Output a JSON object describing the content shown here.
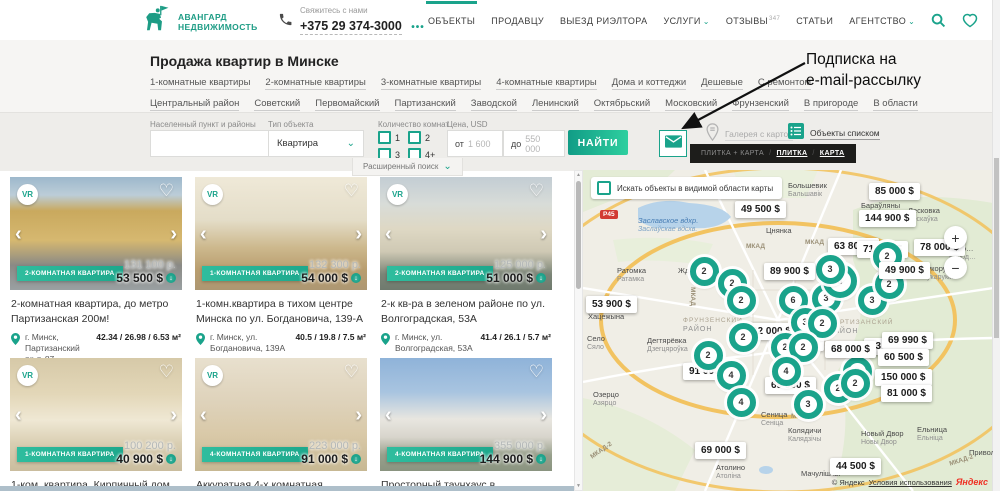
{
  "colors": {
    "accent": "#1aa38b",
    "accent_light": "#2ecf9f",
    "yandex_red": "#ef3124",
    "tooltip_bg": "#1d1d1b"
  },
  "glyphs": {
    "vr": "VR",
    "heart": "♡",
    "chevron_left": "‹",
    "chevron_right": "›",
    "price_drop": "↓",
    "separator": "/",
    "select_chevron": "⌄",
    "nav_chevron": "⌄",
    "scroll_up": "▲",
    "scroll_down": "▼"
  },
  "header": {
    "logo": {
      "line1": "АВАНГАРД",
      "line2": "НЕДВИЖИМОСТЬ"
    },
    "phone": {
      "label": "Свяжитесь с нами",
      "number": "+375 29 374-3000",
      "more": "•••"
    },
    "nav": [
      {
        "label": "ОБЪЕКТЫ",
        "active": true
      },
      {
        "label": "ПРОДАВЦУ"
      },
      {
        "label": "ВЫЕЗД РИЭЛТОРА"
      },
      {
        "label": "УСЛУГИ",
        "chevron": true
      },
      {
        "label": "ОТЗЫВЫ",
        "badge": "347"
      },
      {
        "label": "СТАТЬИ"
      },
      {
        "label": "АГЕНТСТВО",
        "chevron": true
      }
    ]
  },
  "annotation": {
    "line1": "Подписка на",
    "line2": "e-mail-рассылку"
  },
  "intro": {
    "title": "Продажа квартир в Минске",
    "links_row1": [
      "1-комнатные квартиры",
      "2-комнатные квартиры",
      "3-комнатные квартиры",
      "4-комнатные квартиры",
      "Дома и коттеджи",
      "Дешевые",
      "С ремонтом"
    ],
    "links_row2": [
      "Центральный район",
      "Советский",
      "Первомайский",
      "Партизанский",
      "Заводской",
      "Ленинский",
      "Октябрьский",
      "Московский",
      "Фрунзенский",
      "В пригороде",
      "В области"
    ]
  },
  "filters": {
    "location_label": "Населенный пункт и районы",
    "type_label": "Тип объекта",
    "type_value": "Квартира",
    "rooms_label": "Количество комнат",
    "rooms": [
      "1",
      "2",
      "3",
      "4+"
    ],
    "price_label": "Цена, USD",
    "price_from_prefix": "от",
    "price_from": "1 600",
    "price_to_prefix": "до",
    "price_to": "550 000",
    "search_button": "НАЙТИ",
    "advanced": "Расширенный поиск",
    "gallery_label": "Галерея с картой",
    "list_label": "Объекты списком",
    "view_tooltip": [
      {
        "label": "ПЛИТКА + КАРТА",
        "active": false
      },
      {
        "label": "ПЛИТКА",
        "active": true
      },
      {
        "label": "КАРТА",
        "active": true
      }
    ]
  },
  "cards": [
    {
      "vr": true,
      "badge": "2-КОМНАТНАЯ КВАРТИРА",
      "byn": "131 100 р.",
      "usd": "53 500 $",
      "title": "2-комнатная квартира, до метро Партизанская 200м!",
      "loc": "г. Минск, Партизанский пр-т. 87",
      "area": "42.34 / 26.98 / 6.53 м²",
      "photo": "yellow-building"
    },
    {
      "vr": true,
      "badge": "1-КОМНАТНАЯ КВАРТИРА",
      "byn": "132 300 р.",
      "usd": "54 000 $",
      "title": "1-комн.квартира в тихом центре Минска по ул. Богдановича, 139-А",
      "loc": "г. Минск, ул. Богдановича, 139А",
      "area": "40.5 / 19.8 / 7.5 м²",
      "photo": "living-room"
    },
    {
      "vr": true,
      "badge": "2-КОМНАТНАЯ КВАРТИРА",
      "byn": "125 000 р.",
      "usd": "51 000 $",
      "title": "2-к кв-ра в зеленом районе по ул. Волгоградская, 53А",
      "loc": "г. Минск, ул. Волгоградская, 53А",
      "area": "41.4 / 26.1 / 5.7 м²",
      "photo": "beige-room"
    },
    {
      "vr": true,
      "badge": "1-КОМНАТНАЯ КВАРТИРА",
      "byn": "100 200 р.",
      "usd": "40 900 $",
      "title": "1-ком. квартира. Кирпичный дом. 150 метров",
      "photo": "warm-room"
    },
    {
      "vr": true,
      "badge": "4-КОМНАТНАЯ КВАРТИРА",
      "byn": "223 000 р.",
      "usd": "91 000 $",
      "title": "Аккуратная 4-х комнатная квартира с",
      "photo": "bedroom"
    },
    {
      "vr": false,
      "badge": "4-КОМНАТНАЯ КВАРТИРА",
      "byn": "355 000 р.",
      "usd": "144 900 $",
      "title": "Просторный таунхаус в экологически чистом",
      "photo": "townhouse"
    }
  ],
  "map": {
    "search_area_label": "Искать объекты в видимой области карты",
    "zoom_in": "+",
    "zoom_out": "−",
    "road_badge": "Р45",
    "copyright": {
      "prefix": "© Яндекс",
      "link": "Условия использования",
      "brand": "Яндекс"
    },
    "price_labels": [
      {
        "t": "49 500 $",
        "x": 152,
        "y": 31
      },
      {
        "t": "85 000 $",
        "x": 286,
        "y": 13
      },
      {
        "t": "144 900 $",
        "x": 276,
        "y": 40
      },
      {
        "t": "78 000 $",
        "x": 331,
        "y": 69
      },
      {
        "t": "63 800 $",
        "x": 245,
        "y": 68,
        "p": true
      },
      {
        "t": "71 000 $",
        "x": 274,
        "y": 71,
        "p": true
      },
      {
        "t": "49 900 $",
        "x": 296,
        "y": 92
      },
      {
        "t": "89 900 $",
        "x": 181,
        "y": 93
      },
      {
        "t": "53 900 $",
        "x": 3,
        "y": 126
      },
      {
        "t": "32 000 $",
        "x": 163,
        "y": 153,
        "p": true
      },
      {
        "t": "22 000 $",
        "x": 190,
        "y": 164,
        "p": true
      },
      {
        "t": "68 000 $",
        "x": 242,
        "y": 171
      },
      {
        "t": "43",
        "x": 281,
        "y": 168,
        "p": true
      },
      {
        "t": "69 990 $",
        "x": 299,
        "y": 162
      },
      {
        "t": "60 500 $",
        "x": 295,
        "y": 179
      },
      {
        "t": "150 000 $",
        "x": 292,
        "y": 199
      },
      {
        "t": "91 000 $",
        "x": 100,
        "y": 193,
        "p": true
      },
      {
        "t": "69 900 $",
        "x": 182,
        "y": 207,
        "p": true
      },
      {
        "t": "81 000 $",
        "x": 298,
        "y": 215
      },
      {
        "t": "69 000 $",
        "x": 112,
        "y": 272
      },
      {
        "t": "44 500 $",
        "x": 247,
        "y": 288
      }
    ],
    "clusters": [
      {
        "n": "2",
        "x": 121,
        "y": 101
      },
      {
        "n": "2",
        "x": 149,
        "y": 113
      },
      {
        "n": "2",
        "x": 158,
        "y": 130
      },
      {
        "n": "6",
        "x": 210,
        "y": 130
      },
      {
        "n": "3",
        "x": 243,
        "y": 128
      },
      {
        "n": "3",
        "x": 257,
        "y": 111,
        "s": 34
      },
      {
        "n": "3",
        "x": 247,
        "y": 99
      },
      {
        "n": "3",
        "x": 289,
        "y": 130
      },
      {
        "n": "2",
        "x": 306,
        "y": 114
      },
      {
        "n": "2",
        "x": 304,
        "y": 86
      },
      {
        "n": "3",
        "x": 222,
        "y": 152
      },
      {
        "n": "2",
        "x": 239,
        "y": 153
      },
      {
        "n": "2",
        "x": 160,
        "y": 167
      },
      {
        "n": "2",
        "x": 202,
        "y": 177
      },
      {
        "n": "2",
        "x": 220,
        "y": 177
      },
      {
        "n": "2",
        "x": 125,
        "y": 185
      },
      {
        "n": "4",
        "x": 203,
        "y": 201
      },
      {
        "n": "3",
        "x": 274,
        "y": 201
      },
      {
        "n": "4",
        "x": 148,
        "y": 205
      },
      {
        "n": "4",
        "x": 158,
        "y": 232
      },
      {
        "n": "3",
        "x": 225,
        "y": 234
      },
      {
        "n": "2",
        "x": 255,
        "y": 218
      },
      {
        "n": "2",
        "x": 272,
        "y": 213
      }
    ],
    "places": [
      {
        "l1": "Заславское вдхр.",
        "l2": "Заслаўскае вдсхв.",
        "x": 55,
        "y": 46,
        "kind": "water"
      },
      {
        "l1": "Цнянка",
        "x": 183,
        "y": 56,
        "kind": "town"
      },
      {
        "l1": "Большевик",
        "l2": "Бальшавік",
        "x": 205,
        "y": 11,
        "kind": "town"
      },
      {
        "l1": "Бараўляны",
        "x": 278,
        "y": 31,
        "kind": "town"
      },
      {
        "l1": "Лесковка",
        "l2": "Лескаўка",
        "x": 325,
        "y": 36,
        "kind": "town"
      },
      {
        "l1": "Коло…",
        "l2": "Калод…",
        "x": 366,
        "y": 74,
        "kind": "town"
      },
      {
        "l1": "Сукорукие",
        "l2": "Сукарукія",
        "x": 339,
        "y": 94,
        "kind": "town"
      },
      {
        "l1": "Ратомка",
        "l2": "Ратамка",
        "x": 34,
        "y": 96,
        "kind": "town"
      },
      {
        "l1": "Жда…",
        "x": 95,
        "y": 96,
        "kind": "town"
      },
      {
        "l1": "Хацежына",
        "x": 5,
        "y": 142,
        "kind": "town"
      },
      {
        "l1": "Село",
        "l2": "Сяло",
        "x": 4,
        "y": 164,
        "kind": "town"
      },
      {
        "l1": "Дегтярёвка",
        "l2": "Дзегцяроўка",
        "x": 64,
        "y": 166,
        "kind": "town"
      },
      {
        "l1": "ФРУНЗЕНСКИЙ",
        "l2": "РАЙОН",
        "x": 100,
        "y": 146,
        "kind": "district"
      },
      {
        "l1": "ПАРТИЗАНСКИЙ",
        "l2": "РАЙОН",
        "x": 246,
        "y": 148,
        "kind": "district"
      },
      {
        "l1": "Озерцо",
        "l2": "Азярцо",
        "x": 10,
        "y": 220,
        "kind": "town"
      },
      {
        "l1": "Сеница",
        "l2": "Сеніца",
        "x": 178,
        "y": 240,
        "kind": "town"
      },
      {
        "l1": "Колядичи",
        "l2": "Калядзічы",
        "x": 205,
        "y": 256,
        "kind": "town"
      },
      {
        "l1": "Новый Двор",
        "l2": "Новы Двор",
        "x": 278,
        "y": 259,
        "kind": "town"
      },
      {
        "l1": "Ельница",
        "l2": "Ельніца",
        "x": 334,
        "y": 255,
        "kind": "town"
      },
      {
        "l1": "Привольны…",
        "x": 386,
        "y": 278,
        "kind": "town"
      },
      {
        "l1": "Атолино",
        "l2": "Атоліна",
        "x": 133,
        "y": 293,
        "kind": "town"
      },
      {
        "l1": "Мачулішчы",
        "x": 218,
        "y": 299,
        "kind": "town"
      },
      {
        "l1": "МКАД",
        "x": 163,
        "y": 72,
        "kind": "road"
      },
      {
        "l1": "МКАД",
        "x": 222,
        "y": 68,
        "kind": "road"
      },
      {
        "l1": "МКАД",
        "x": 100,
        "y": 122,
        "kind": "road",
        "rot": 90
      },
      {
        "l1": "МКАД",
        "x": 208,
        "y": 242,
        "kind": "road"
      },
      {
        "l1": "МКАД-2",
        "x": 6,
        "y": 276,
        "kind": "road",
        "rot": -35
      },
      {
        "l1": "МКАД-2",
        "x": 366,
        "y": 286,
        "kind": "road",
        "rot": -18
      }
    ]
  }
}
